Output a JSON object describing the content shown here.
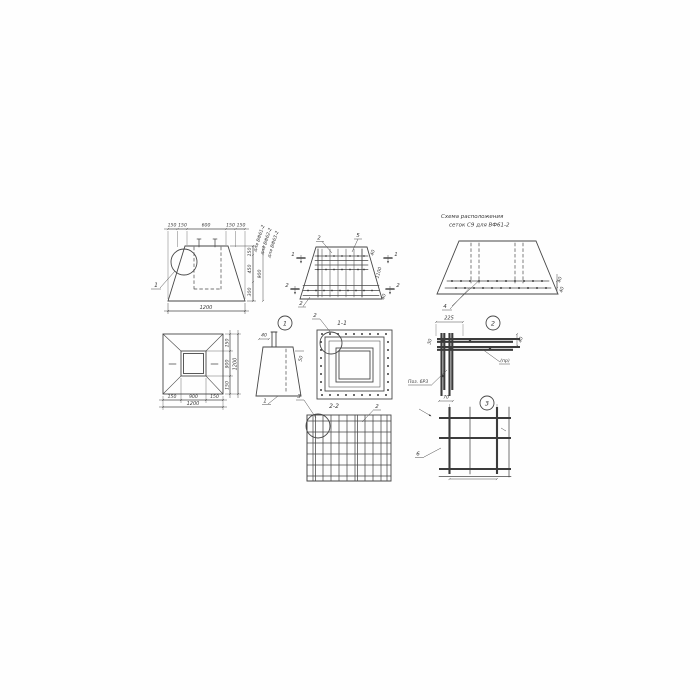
{
  "page": {
    "background": "#fefefe",
    "line_color": "#474747"
  },
  "views": {
    "elevation": {
      "callout": "1",
      "dims_top": [
        "150",
        "150",
        "600",
        "150",
        "150"
      ],
      "dims_right": [
        "150",
        "450",
        "300"
      ],
      "dim_right_total": "900",
      "notes_right": [
        "для ВФ61-2",
        "для ВФ62-2",
        "для ВФ63-2"
      ],
      "dim_bottom": "1200"
    },
    "reinforcement": {
      "mark_left1": "1",
      "mark_right1": "1",
      "mark_left2": "2",
      "mark_right2": "2",
      "leader_a": "2",
      "leader_b": "5",
      "leader_c": "2",
      "dim_right_top": "40",
      "dim_right_mid": "1100",
      "dim_right_bot": "40"
    },
    "scheme": {
      "title_line1": "Схема расположения",
      "title_line2": "сеток С9  для ВФ61-2",
      "leader": "4",
      "dim_r1": "40",
      "dim_r2": "40"
    },
    "plan": {
      "dims_bottom": [
        "150",
        "900",
        "150"
      ],
      "dim_bottom_total": "1200",
      "dims_right": [
        "150",
        "900",
        "150"
      ],
      "dim_right_total": "1200"
    },
    "detail1": {
      "number": "1",
      "dim_top": "40",
      "dim_right": "50",
      "leader": "1"
    },
    "section11": {
      "title": "1-1",
      "leader": "2"
    },
    "detail2": {
      "number": "2",
      "dim_top": "225",
      "dim_right": "40",
      "dim_left": "30",
      "label_right": "(пр)",
      "label_left": "Поз. 6Р3"
    },
    "section22": {
      "title": "2-2",
      "leader_left": "3",
      "leader_right": "2"
    },
    "detail3": {
      "number": "3",
      "dim_top": "70",
      "leader": "6"
    }
  }
}
